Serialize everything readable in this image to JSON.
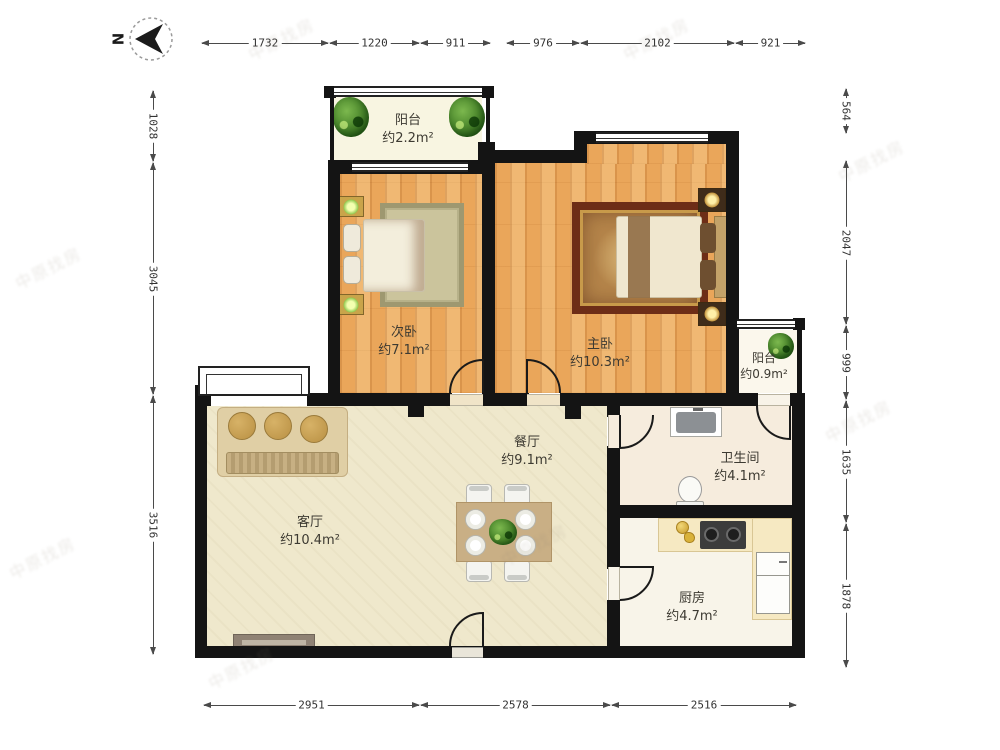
{
  "north": {
    "label": "N"
  },
  "rooms": [
    {
      "id": "balcony-top",
      "name": "阳台",
      "area": "约2.2m²"
    },
    {
      "id": "second-bedroom",
      "name": "次卧",
      "area": "约7.1m²"
    },
    {
      "id": "master-bedroom",
      "name": "主卧",
      "area": "约10.3m²"
    },
    {
      "id": "balcony-right",
      "name": "阳台",
      "area": "约0.9m²"
    },
    {
      "id": "dining-room",
      "name": "餐厅",
      "area": "约9.1m²"
    },
    {
      "id": "living-room",
      "name": "客厅",
      "area": "约10.4m²"
    },
    {
      "id": "bathroom",
      "name": "卫生间",
      "area": "约4.1m²"
    },
    {
      "id": "kitchen",
      "name": "厨房",
      "area": "约4.7m²"
    }
  ],
  "dimensions": {
    "top": [
      "1732",
      "1220",
      "911",
      "976",
      "2102",
      "921"
    ],
    "bottom": [
      "2951",
      "2578",
      "2516"
    ],
    "left": [
      "1028",
      "3045",
      "3516"
    ],
    "right": [
      "564",
      "2047",
      "999",
      "1635",
      "1878"
    ]
  },
  "watermark": {
    "text": "中原找房"
  },
  "colors": {
    "wall": "#141414",
    "wood_floor": "#EAA65A",
    "living_floor": "#EFE8CC",
    "bathroom_floor": "#F6ECDD",
    "kitchen_floor": "#F8F4E9",
    "counter": "#F6E9C2",
    "rug_master_border": "#6D2D17",
    "rug_second": "#CBC49C",
    "plant_green": "#4E8A2E"
  }
}
